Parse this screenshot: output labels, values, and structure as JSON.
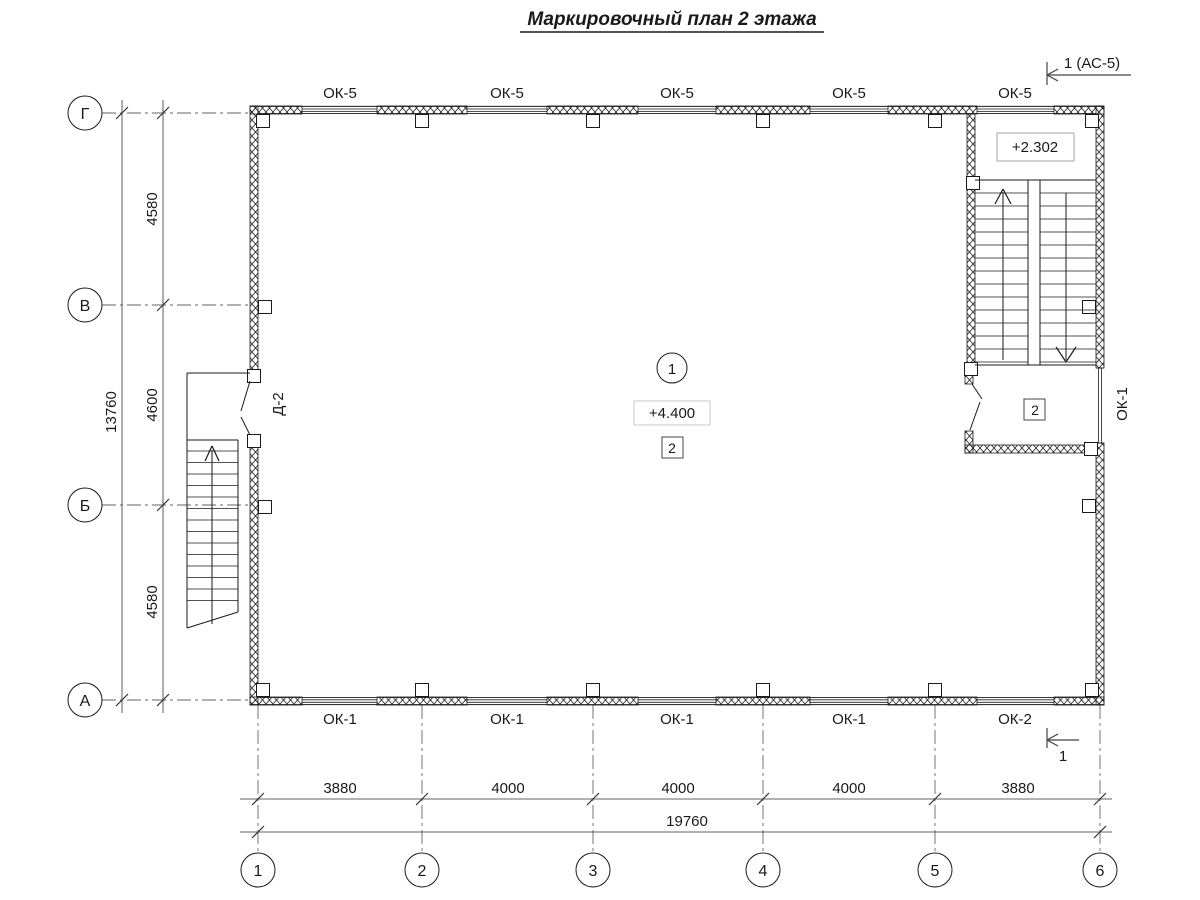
{
  "title": "Маркировочный план 2 этажа",
  "plan": {
    "room_number": "1",
    "elevation_main": "+4.400",
    "floor_mark_main": "2",
    "elevation_stair_landing": "+2.302",
    "floor_mark_vestibule": "2",
    "door_label": "Д-2",
    "window_label_right": "ОК-1"
  },
  "window_labels_top": [
    "ОК-5",
    "ОК-5",
    "ОК-5",
    "ОК-5",
    "ОК-5"
  ],
  "window_labels_bottom": [
    "ОК-1",
    "ОК-1",
    "ОК-1",
    "ОК-1",
    "ОК-2"
  ],
  "section_markers": {
    "top": "1 (АС-5)",
    "bottom": "1"
  },
  "axes": {
    "left": [
      "Г",
      "В",
      "Б",
      "А"
    ],
    "bottom": [
      "1",
      "2",
      "3",
      "4",
      "5",
      "6"
    ]
  },
  "dimensions": {
    "bottom_segments": [
      "3880",
      "4000",
      "4000",
      "4000",
      "3880"
    ],
    "bottom_total": "19760",
    "left_segments": [
      "4580",
      "4600",
      "4580"
    ],
    "left_total": "13760"
  },
  "colors": {
    "line": "#1a1a1a",
    "axis_line": "#666666",
    "background": "#ffffff"
  }
}
